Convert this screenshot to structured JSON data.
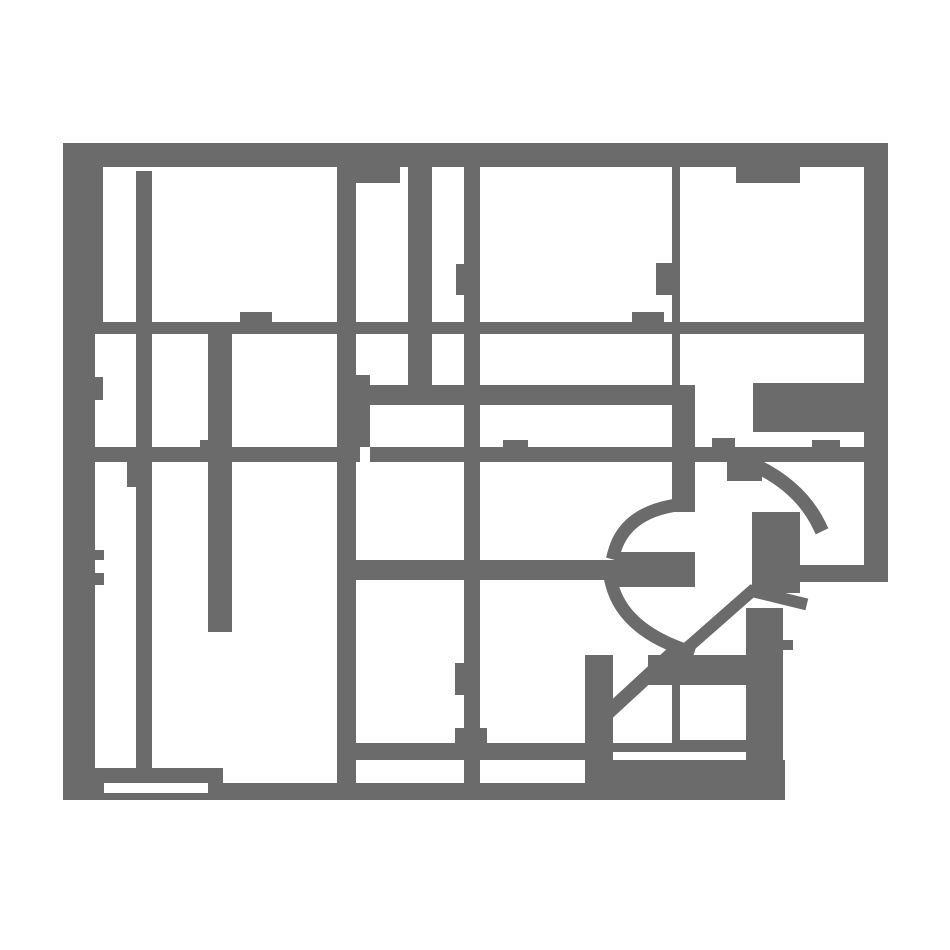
{
  "canvas": {
    "width": 950,
    "height": 950
  },
  "colors": {
    "background": "#ffffff",
    "wall": "#6b6b6b"
  },
  "map": {
    "kind": "floorplan-occupancy-grid",
    "rects": [
      {
        "name": "top-wall",
        "x": 63,
        "y": 143,
        "w": 825,
        "h": 24
      },
      {
        "name": "top-wall-lintel",
        "x": 337,
        "y": 143,
        "w": 63,
        "h": 40
      },
      {
        "name": "left-wall-upper",
        "x": 63,
        "y": 167,
        "w": 40,
        "h": 155
      },
      {
        "name": "left-wall-lower",
        "x": 63,
        "y": 322,
        "w": 32,
        "h": 478
      },
      {
        "name": "right-wall",
        "x": 864,
        "y": 167,
        "w": 24,
        "h": 415
      },
      {
        "name": "bottom-wall-left",
        "x": 63,
        "y": 783,
        "w": 41,
        "h": 17
      },
      {
        "name": "bottom-wall-main",
        "x": 208,
        "y": 783,
        "w": 577,
        "h": 17
      },
      {
        "name": "bottom-wall-under-slot",
        "x": 104,
        "y": 793,
        "w": 104,
        "h": 7
      },
      {
        "name": "wall-a-vertical",
        "x": 136,
        "y": 171,
        "w": 16,
        "h": 597
      },
      {
        "name": "wall-a-step",
        "x": 127,
        "y": 462,
        "w": 9,
        "h": 25
      },
      {
        "name": "wall-b-vertical",
        "x": 337,
        "y": 183,
        "w": 19,
        "h": 600
      },
      {
        "name": "wall-b-widening",
        "x": 356,
        "y": 375,
        "w": 14,
        "h": 72
      },
      {
        "name": "wall-c-vertical",
        "x": 408,
        "y": 165,
        "w": 24,
        "h": 240
      },
      {
        "name": "wall-d-vertical",
        "x": 464,
        "y": 165,
        "w": 16,
        "h": 635
      },
      {
        "name": "wall-d-bump-upper",
        "x": 456,
        "y": 264,
        "w": 8,
        "h": 31
      },
      {
        "name": "wall-d-bump-lower",
        "x": 455,
        "y": 663,
        "w": 9,
        "h": 32
      },
      {
        "name": "wall-d-foot",
        "x": 455,
        "y": 728,
        "w": 32,
        "h": 15
      },
      {
        "name": "wall-e-upper",
        "x": 672,
        "y": 165,
        "w": 8,
        "h": 240
      },
      {
        "name": "wall-e-bump",
        "x": 656,
        "y": 263,
        "w": 24,
        "h": 32
      },
      {
        "name": "wall-e-wide",
        "x": 672,
        "y": 405,
        "w": 23,
        "h": 107
      },
      {
        "name": "wall-e-lower",
        "x": 672,
        "y": 655,
        "w": 8,
        "h": 97
      },
      {
        "name": "wall-f-vertical",
        "x": 208,
        "y": 334,
        "w": 24,
        "h": 298
      },
      {
        "name": "wall-f-cap",
        "x": 200,
        "y": 440,
        "w": 8,
        "h": 7
      },
      {
        "name": "wall-g-vertical",
        "x": 585,
        "y": 655,
        "w": 28,
        "h": 145
      },
      {
        "name": "band-1",
        "x": 63,
        "y": 322,
        "w": 802,
        "h": 12
      },
      {
        "name": "band-2",
        "x": 337,
        "y": 385,
        "w": 358,
        "h": 20
      },
      {
        "name": "block-right-upper",
        "x": 753,
        "y": 383,
        "w": 111,
        "h": 49
      },
      {
        "name": "band-3-left",
        "x": 63,
        "y": 447,
        "w": 297,
        "h": 15
      },
      {
        "name": "band-3-right",
        "x": 370,
        "y": 447,
        "w": 518,
        "h": 15
      },
      {
        "name": "band-4-bottom-left",
        "x": 95,
        "y": 768,
        "w": 128,
        "h": 15
      },
      {
        "name": "band-5-left",
        "x": 337,
        "y": 743,
        "w": 263,
        "h": 17
      },
      {
        "name": "band-5-mid",
        "x": 600,
        "y": 743,
        "w": 73,
        "h": 9
      },
      {
        "name": "band-5-right",
        "x": 680,
        "y": 740,
        "w": 72,
        "h": 12
      },
      {
        "name": "block-bottom-mid",
        "x": 585,
        "y": 760,
        "w": 200,
        "h": 23
      },
      {
        "name": "bump-room-top-left",
        "x": 240,
        "y": 312,
        "w": 32,
        "h": 10
      },
      {
        "name": "block-small-mid",
        "x": 632,
        "y": 312,
        "w": 32,
        "h": 10
      },
      {
        "name": "bump-top-right",
        "x": 736,
        "y": 165,
        "w": 64,
        "h": 18
      },
      {
        "name": "bump-band2-a",
        "x": 503,
        "y": 440,
        "w": 25,
        "h": 7
      },
      {
        "name": "bump-band2-b",
        "x": 712,
        "y": 438,
        "w": 23,
        "h": 9
      },
      {
        "name": "bump-band2-c",
        "x": 812,
        "y": 440,
        "w": 28,
        "h": 7
      },
      {
        "name": "bump-left-wall-a",
        "x": 95,
        "y": 377,
        "w": 8,
        "h": 23
      },
      {
        "name": "bump-left-wall-b",
        "x": 95,
        "y": 550,
        "w": 9,
        "h": 10
      },
      {
        "name": "bump-left-wall-c",
        "x": 95,
        "y": 573,
        "w": 9,
        "h": 12
      },
      {
        "name": "step-below-band2",
        "x": 727,
        "y": 462,
        "w": 35,
        "h": 19
      },
      {
        "name": "block-right-mid",
        "x": 752,
        "y": 512,
        "w": 48,
        "h": 81
      },
      {
        "name": "bar-right",
        "x": 800,
        "y": 565,
        "w": 88,
        "h": 17
      },
      {
        "name": "column-bottom-right",
        "x": 746,
        "y": 608,
        "w": 37,
        "h": 192
      },
      {
        "name": "tiny-block",
        "x": 783,
        "y": 640,
        "w": 10,
        "h": 10
      },
      {
        "name": "block-circle-south",
        "x": 648,
        "y": 655,
        "w": 104,
        "h": 30
      },
      {
        "name": "bar-center",
        "x": 337,
        "y": 560,
        "w": 278,
        "h": 20
      },
      {
        "name": "blob-center",
        "x": 615,
        "y": 552,
        "w": 80,
        "h": 35
      }
    ],
    "paths": [
      {
        "name": "arc-upper-left",
        "d": "M 671 506 Q 624 515 614 553",
        "width": 13
      },
      {
        "name": "arc-lower-left",
        "d": "M 612 585 Q 624 630 688 651",
        "width": 13
      },
      {
        "name": "arc-outer-right",
        "d": "M 748 462 Q 799 484 819 525",
        "width": 14
      },
      {
        "name": "chord-diagonal",
        "d": "M 686 649 L 752 591 L 801 603",
        "width": 12
      },
      {
        "name": "diagonal-lower",
        "d": "M 599 721 L 676 650",
        "width": 14
      }
    ]
  }
}
